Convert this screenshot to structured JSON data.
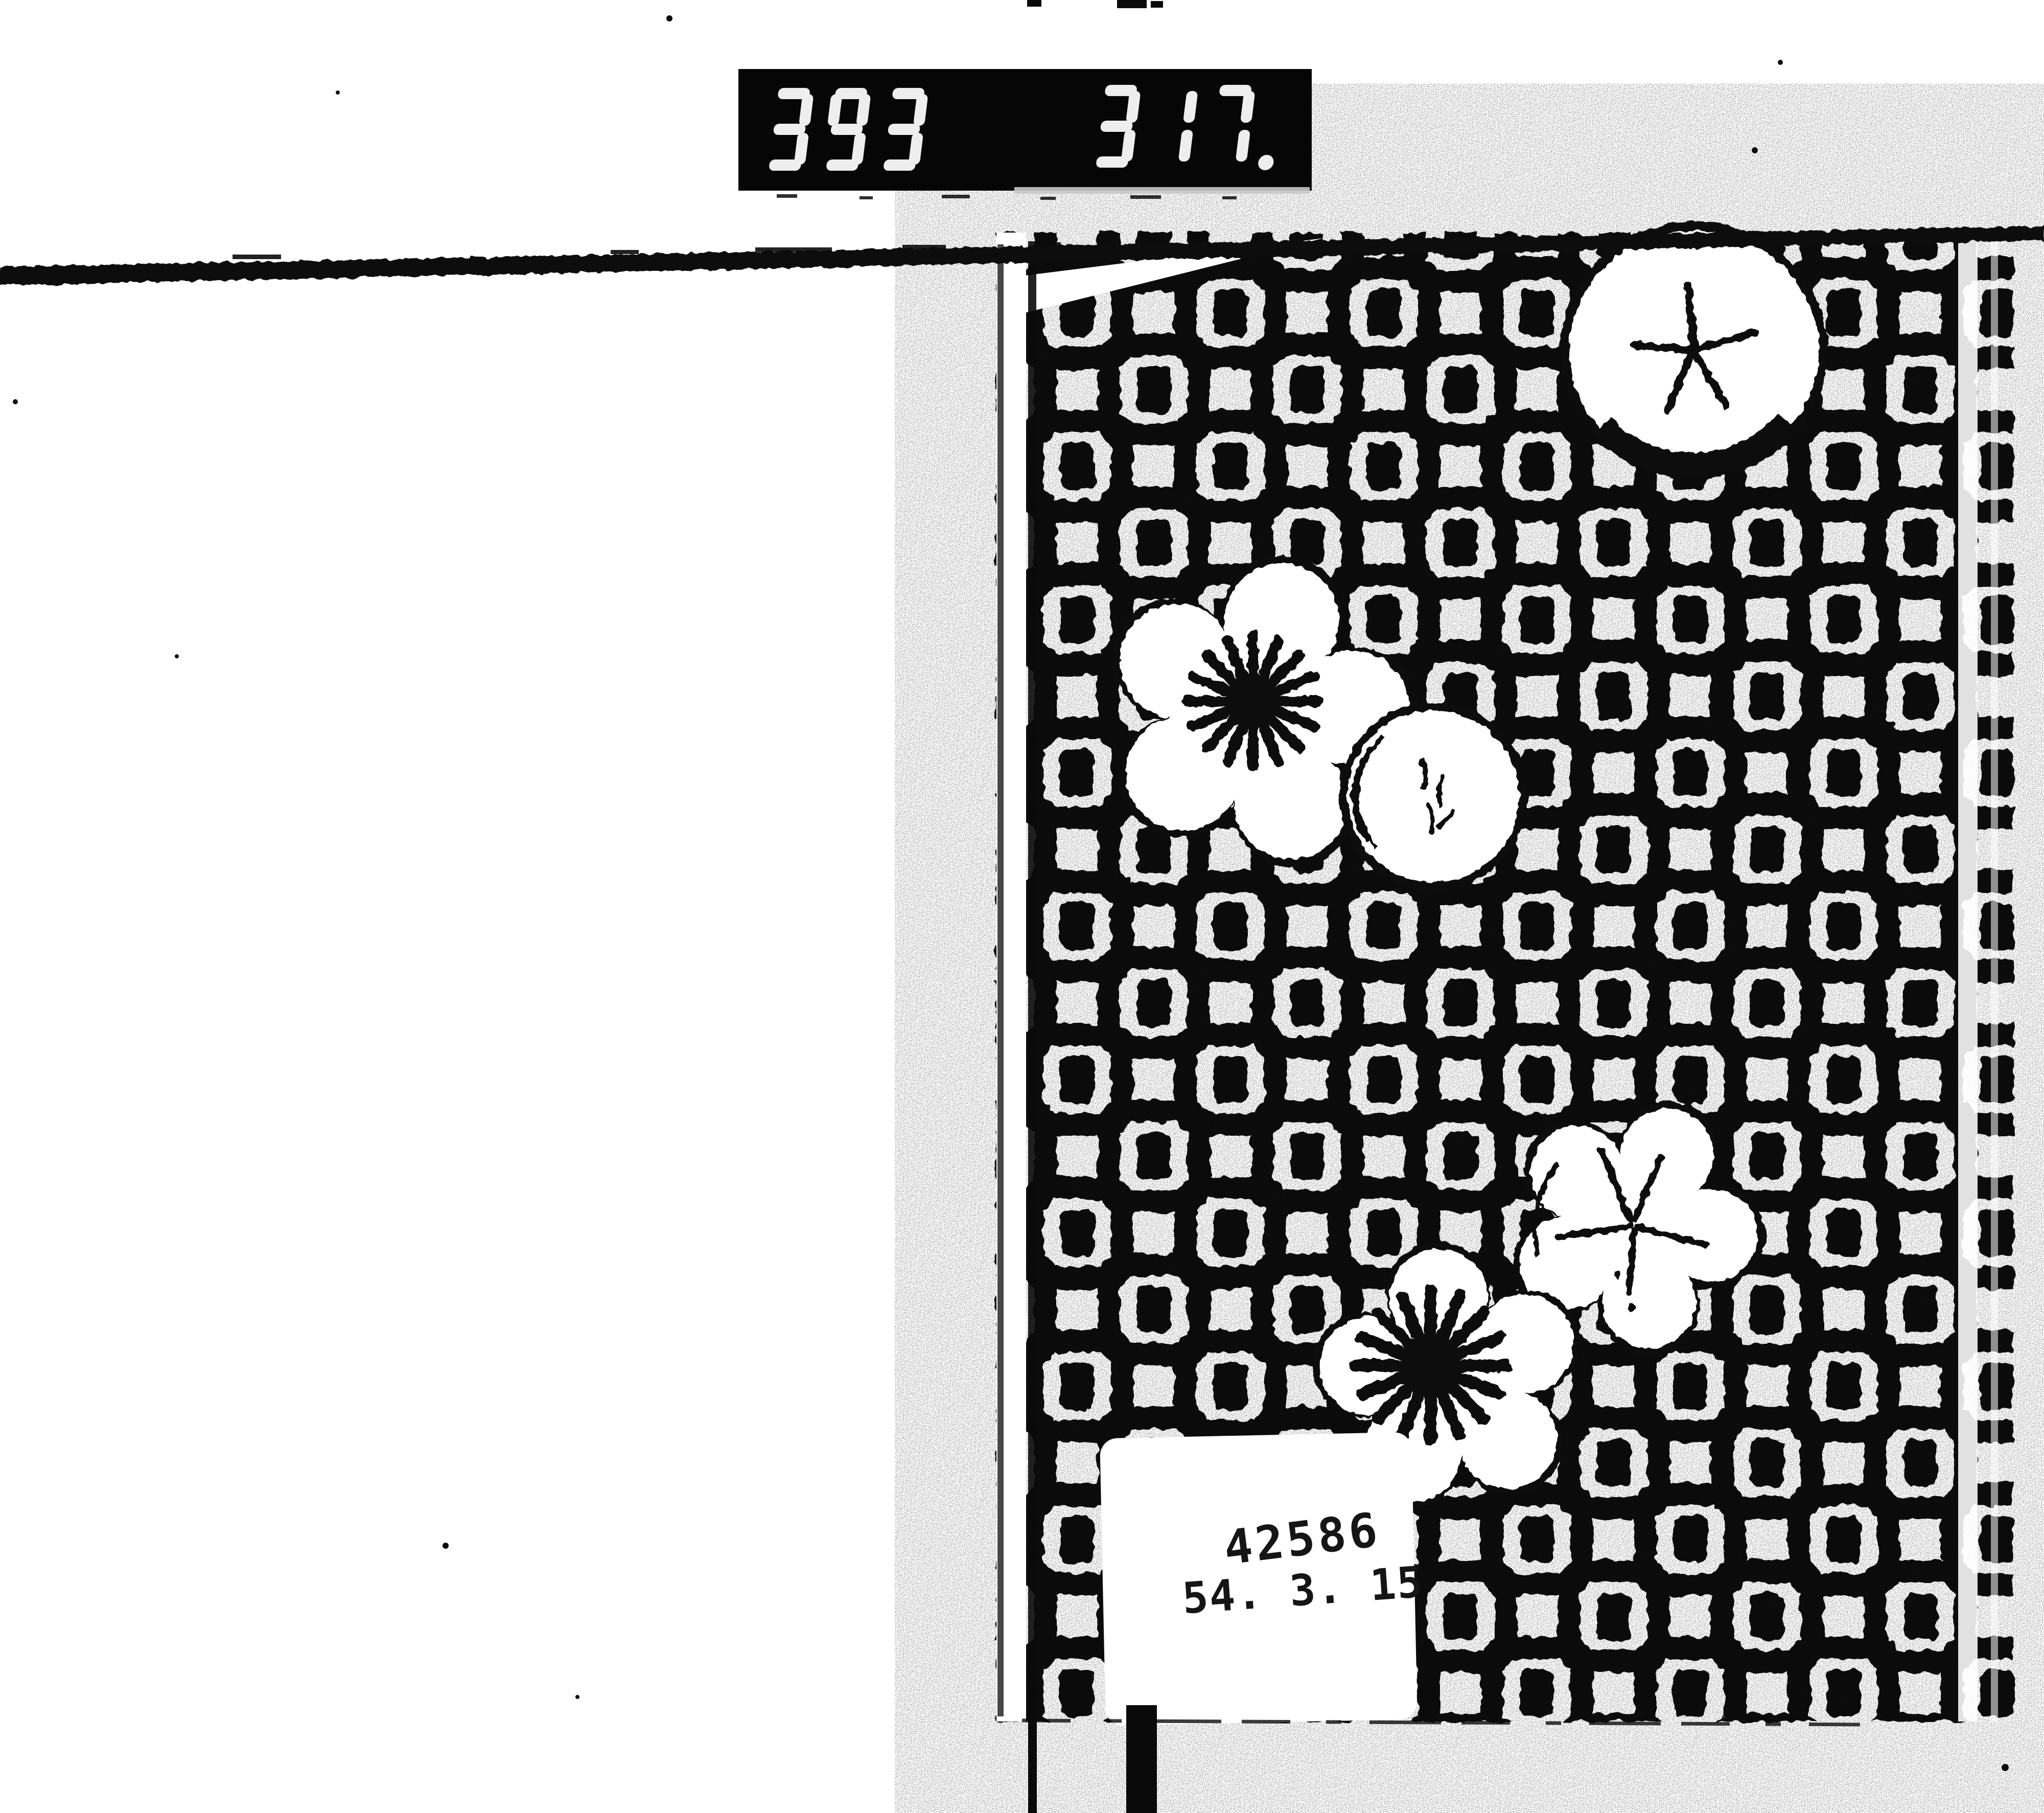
{
  "page": {
    "paper_color": "#ffffff",
    "ink_color": "#0a0a0a"
  },
  "counter_plate": {
    "left_digits": "393",
    "right_digits": "317.",
    "style": "seven-segment",
    "digit_color": "#eeeeee",
    "plate_color": "#060606"
  },
  "stamp": {
    "line1": "42586",
    "line2": "54. 3. 15"
  },
  "swatch": {
    "pattern_icon": "interlocking-square-lattice-pattern",
    "motifs": [
      {
        "icon": "plum-blossom-star-center",
        "position": "top-right"
      },
      {
        "icon": "plum-blossom-ray-center",
        "position": "middle-left"
      },
      {
        "icon": "round-bud",
        "position": "middle-center"
      },
      {
        "icon": "plum-blossom-star-center",
        "position": "lower-right"
      },
      {
        "icon": "plum-blossom-ray-center",
        "position": "bottom-center"
      }
    ]
  }
}
